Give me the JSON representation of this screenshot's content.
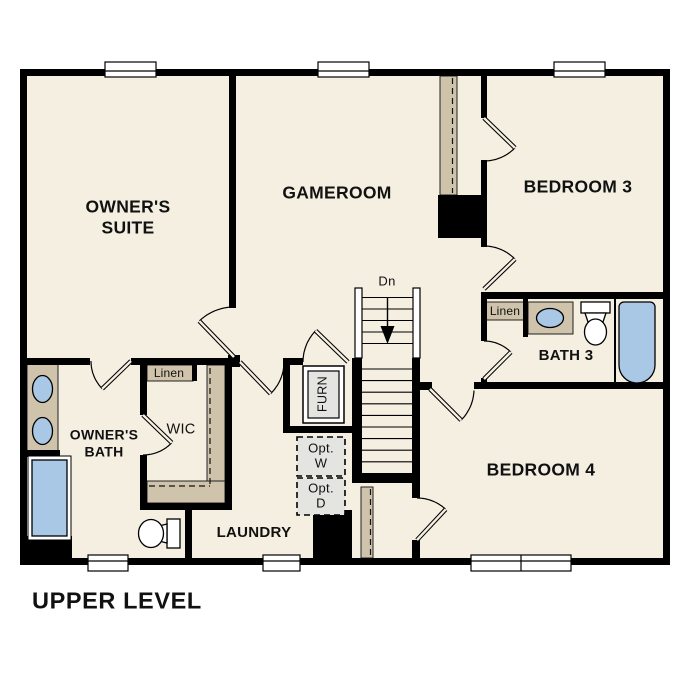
{
  "plan": {
    "title": "UPPER LEVEL",
    "rooms": {
      "owners_suite": "OWNER'S SUITE",
      "gameroom": "GAMEROOM",
      "bedroom3": "BEDROOM 3",
      "bath3": "BATH 3",
      "bedroom4": "BEDROOM 4",
      "owners_bath": "OWNER'S BATH",
      "wic": "WIC",
      "laundry": "LAUNDRY"
    },
    "labels": {
      "linen_wic": "Linen",
      "linen_bath3": "Linen",
      "furnace": "FURN",
      "opt_washer": "Opt. W",
      "opt_dryer": "Opt. D",
      "stairs_down": "Dn"
    }
  },
  "colors": {
    "floor": "#f5efe2",
    "wall": "#000000",
    "casework": "#cfc3ab",
    "fixture_blue": "#a9c8e5",
    "equipment_gray": "#e4e4e1",
    "background": "#ffffff",
    "text": "#111111"
  }
}
